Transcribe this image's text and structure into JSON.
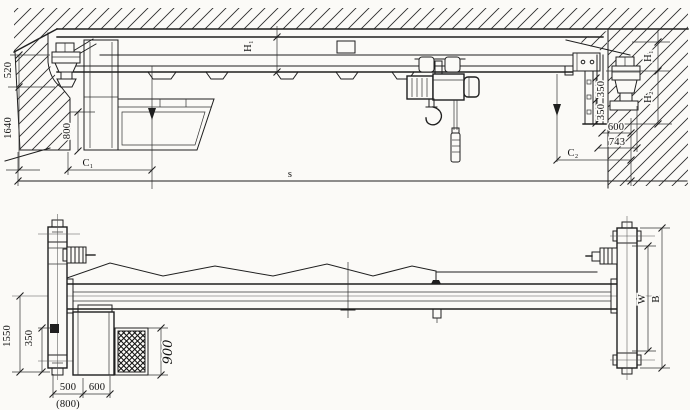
{
  "drawing": {
    "kind": "technical-engineering-drawing",
    "subject": "electric single-girder overhead crane, general arrangement, two views",
    "ink_color": "#1f1f1f",
    "paper_color": "#fbfaf7"
  },
  "top_view": {
    "dims": {
      "d520": "520",
      "d1640": "1640",
      "d800": "800",
      "c1": "C₁",
      "span": "s",
      "h1_girder": "H₁",
      "d350_upper": "350",
      "d350_lower": "350",
      "d600": "600",
      "d743": "743",
      "c2": "C₂",
      "h1": "H₁",
      "h2": "H₂"
    }
  },
  "plan_view": {
    "dims": {
      "d1550": "1550",
      "d350": "350",
      "d900": "900",
      "d500": "500",
      "d600": "600",
      "d800_alt": "(800)",
      "w": "W",
      "b": "B"
    }
  }
}
